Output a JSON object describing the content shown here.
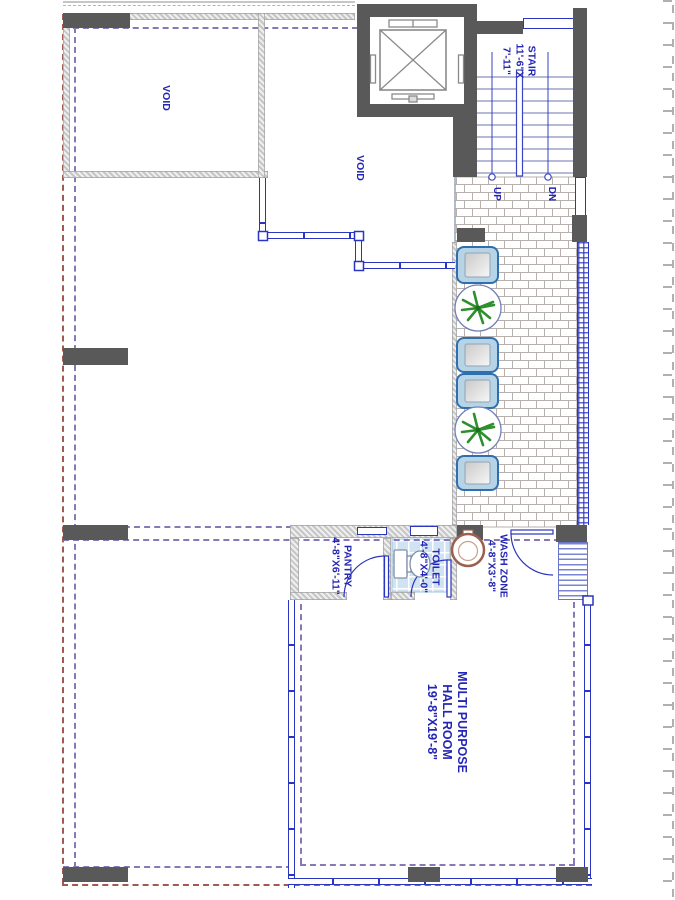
{
  "drawing": {
    "type": "architectural floor plan",
    "rooms": {
      "void1": {
        "label": "VOID"
      },
      "void2": {
        "label": "VOID"
      },
      "stair": {
        "label": "STAIR",
        "dim1": "11'-6\"X",
        "dim2": "7'-11\"",
        "up": "UP",
        "dn": "DN"
      },
      "pantry": {
        "label": "PANTRY",
        "dim": "4'-8\"X6'-11\""
      },
      "toilet": {
        "label": "TOILET",
        "dim": "4'-8\"X4'-0\""
      },
      "wash_zone": {
        "label": "WASH ZONE",
        "dim": "4'-8\"X3'-8\""
      },
      "hall": {
        "line1": "MULTI PURPOSE",
        "line2": "HALL ROOM",
        "dim": "19'-8\"X19'-8\""
      }
    },
    "fixtures": {
      "washbasins": 4,
      "planters": 2,
      "wc": 1,
      "round_wash_basin": 1,
      "elevator": 1
    },
    "colors": {
      "wall_dark": "#595959",
      "window_blue": "#2a35c0",
      "label_blue": "#2326b4",
      "dash_purple": "#8878b8",
      "dash_maroon": "#a05a52",
      "tile_joint": "#b8b0ac",
      "toilet_tile": "#cfe3f2",
      "plant_green": "#2e8f2e",
      "basin_fill": "#b7d4e6",
      "basin_rim": "#9a6050"
    }
  }
}
